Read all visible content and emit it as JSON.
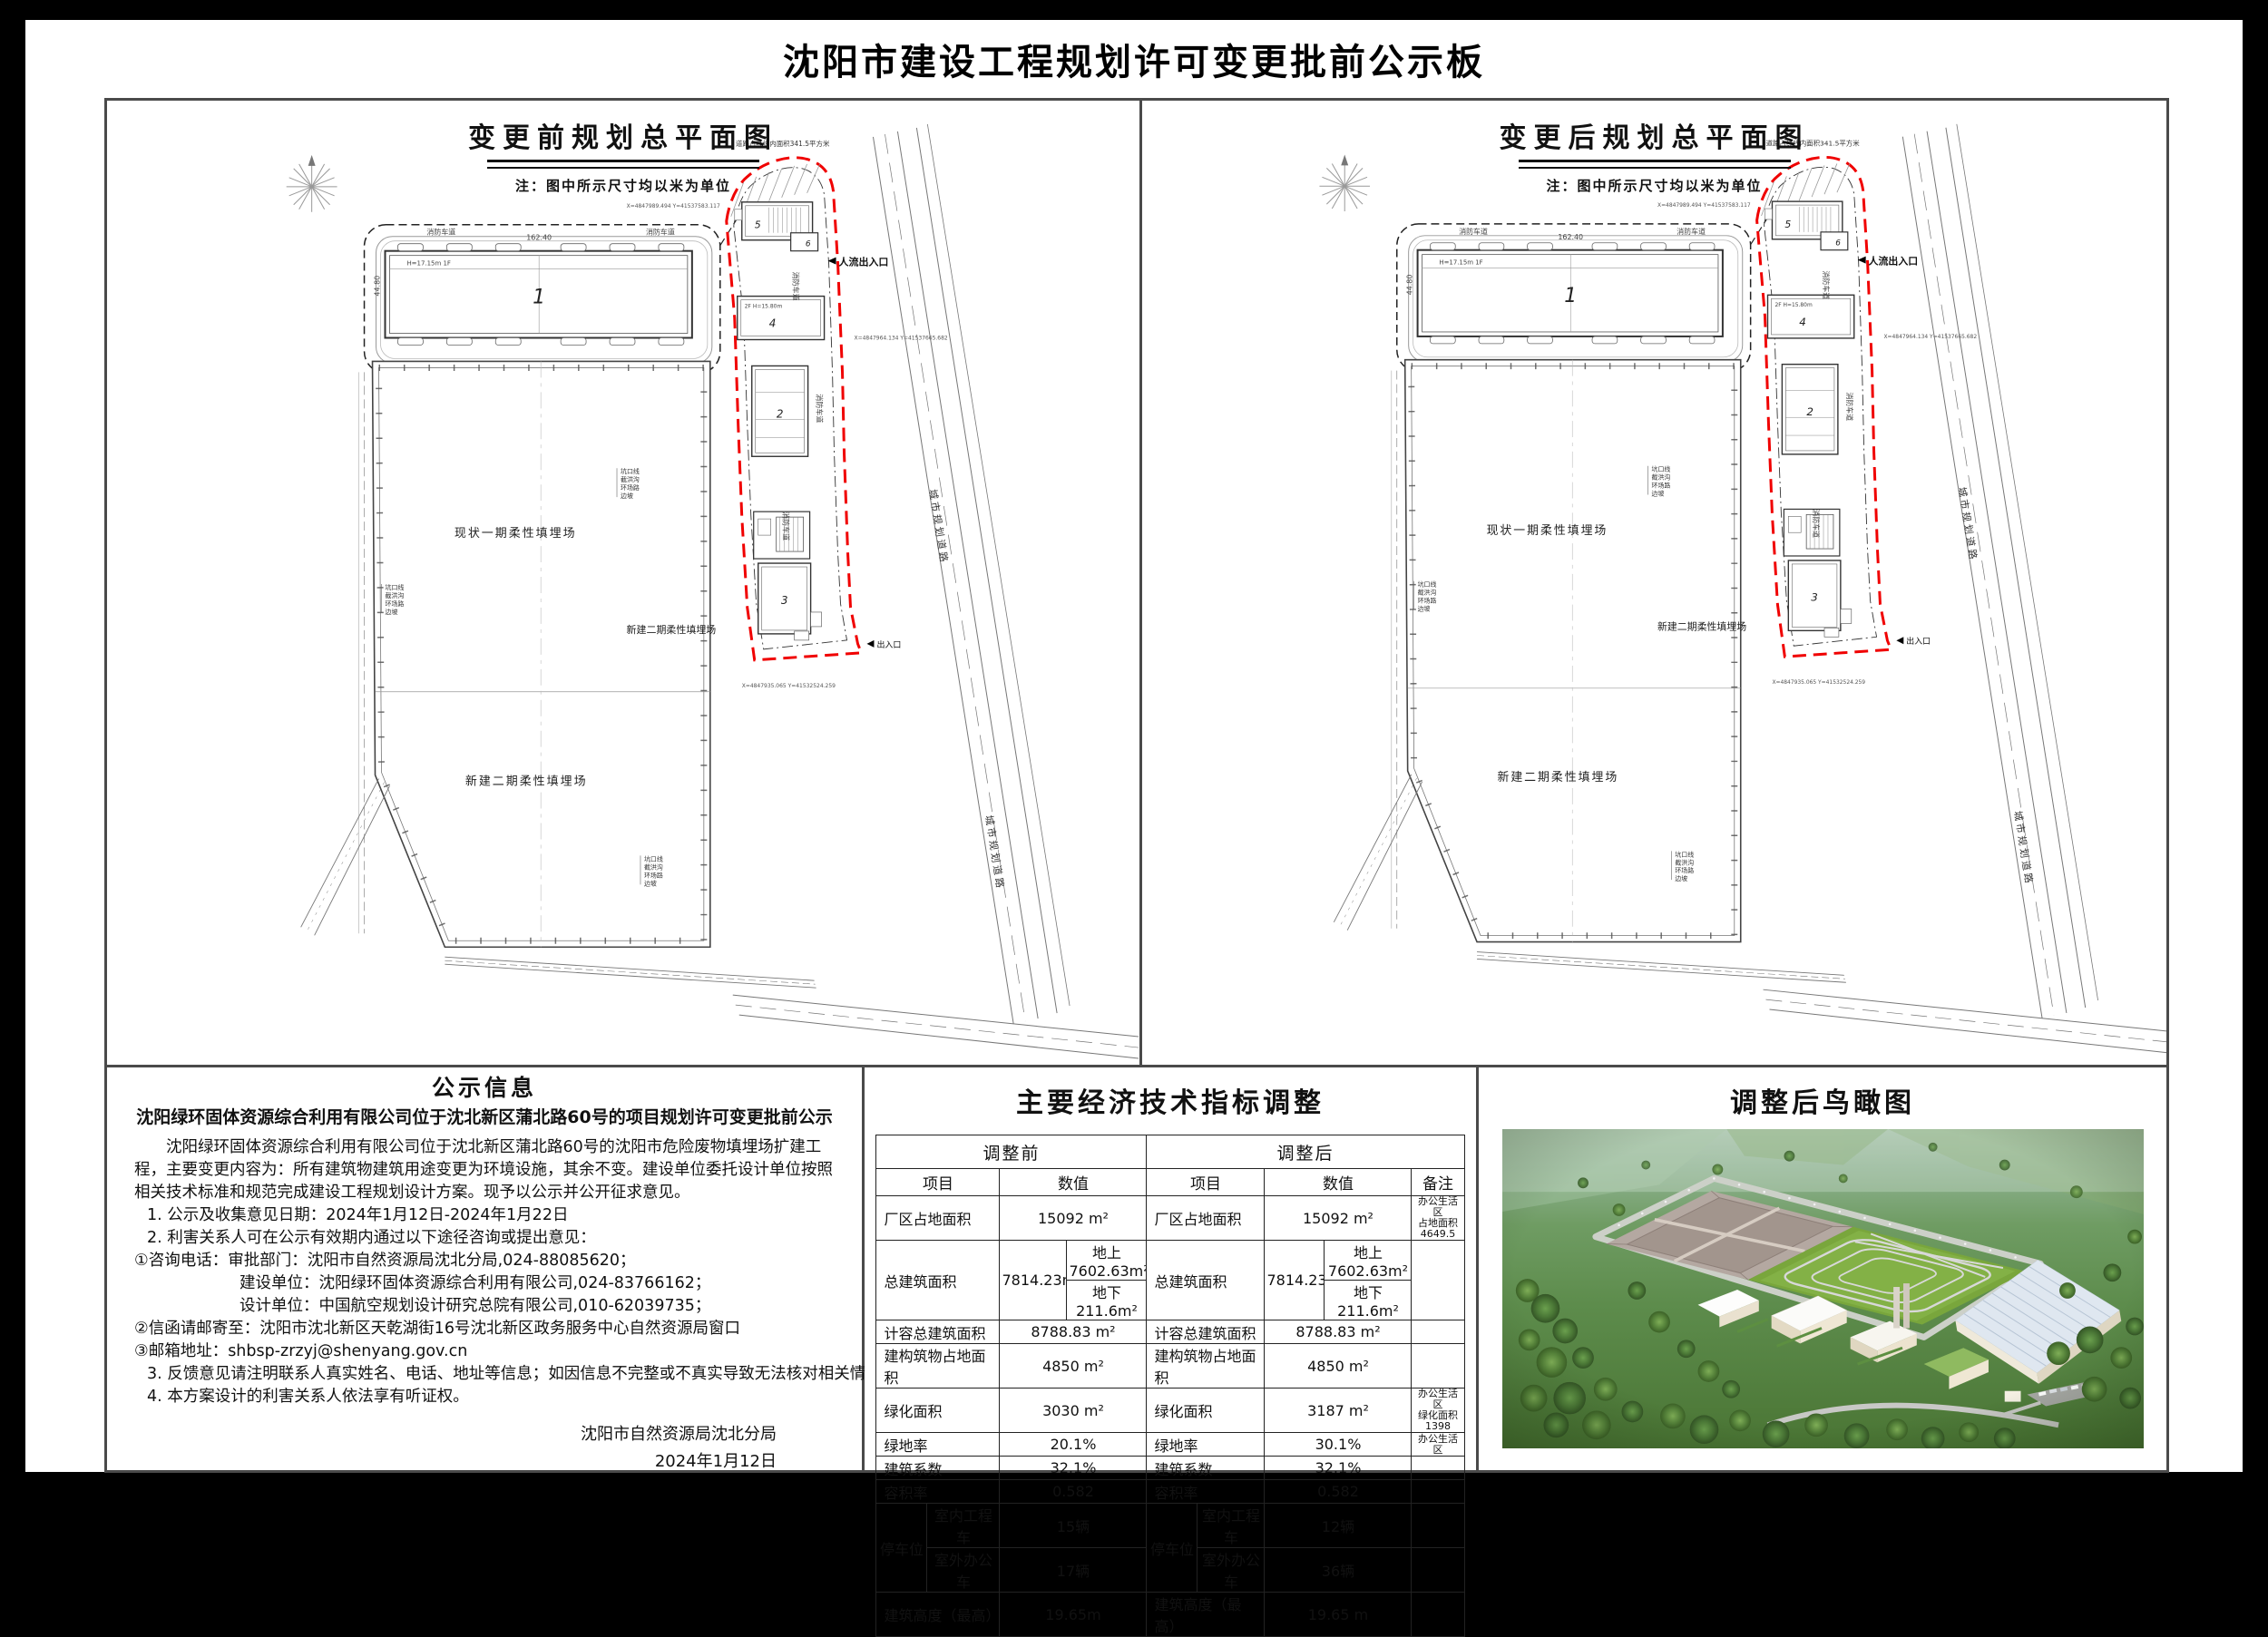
{
  "page_title": "沈阳市建设工程规划许可变更批前公示板",
  "panels": {
    "before": {
      "title": "变更前规划总平面图",
      "note": "注：图中所示尺寸均以米为单位"
    },
    "after": {
      "title": "变更后规划总平面图",
      "note": "注：图中所示尺寸均以米为单位"
    }
  },
  "plan": {
    "labels": {
      "phase1": "现状一期柔性填埋场",
      "phase2_mid": "新建二期柔性填埋场",
      "phase2_bottom": "新建二期柔性填埋场",
      "fire_lane": "消防车道",
      "entrance_main": "人流出入口",
      "entrance_side": "出入口",
      "city_road": "城市规划道路",
      "city_road2": "城市规划道路",
      "redline_area_note": "道路占红线内面积341.5平方米",
      "bldg1": "1",
      "bldg2": "2",
      "bldg3": "3",
      "bldg4": "4",
      "bldg5": "5",
      "bldg6": "6",
      "bldg1_spec": "H=17.15m 1F",
      "bldg4_spec": "2F H=15.80m",
      "dim_length": "162.40",
      "dim_width": "44.80",
      "legend1": "坑口线",
      "legend2": "截洪沟",
      "legend3": "环场路",
      "legend4": "边坡",
      "coord1": "X=4847989.494 Y=41537583.117",
      "coord2": "X=4847964.134 Y=41537665.682",
      "coord3": "X=4847935.065 Y=41532524.259"
    }
  },
  "notice": {
    "title": "公示信息",
    "subtitle": "沈阳绿环固体资源综合利用有限公司位于沈北新区蒲北路60号的项目规划许可变更批前公示",
    "paragraph": "沈阳绿环固体资源综合利用有限公司位于沈北新区蒲北路60号的沈阳市危险废物填埋场扩建工程，主要变更内容为：所有建筑物建筑用途变更为环境设施，其余不变。建设单位委托设计单位按照相关技术标准和规范完成建设工程规划设计方案。现予以公示并公开征求意见。",
    "lines": [
      "1. 公示及收集意见日期：2024年1月12日-2024年1月22日",
      "2. 利害关系人可在公示有效期内通过以下途径咨询或提出意见：",
      "①咨询电话：审批部门：沈阳市自然资源局沈北分局,024-88085620；",
      "建设单位：沈阳绿环固体资源综合利用有限公司,024-83766162；",
      "设计单位：中国航空规划设计研究总院有限公司,010-62039735；",
      "②信函请邮寄至：沈阳市沈北新区天乾湖街16号沈北新区政务服务中心自然资源局窗口",
      "③邮箱地址：shbsp-zrzyj@shenyang.gov.cn",
      "3. 反馈意见请注明联系人真实姓名、电话、地址等信息；如因信息不完整或不真实导致无法核对相关情况的，视为无效意见。",
      "4. 本方案设计的利害关系人依法享有听证权。"
    ],
    "signature": {
      "agency": "沈阳市自然资源局沈北分局",
      "date": "2024年1月12日"
    }
  },
  "table": {
    "title": "主要经济技术指标调整",
    "header": {
      "before": "调整前",
      "after": "调整后",
      "item": "项目",
      "value": "数值",
      "note": "备注"
    },
    "rows": {
      "site_area": {
        "item": "厂区占地面积",
        "before": "15092 m²",
        "after": "15092 m²",
        "note": "办公生活区\n占地面积4649.5"
      },
      "total_floor": {
        "item": "总建筑面积",
        "main": "7814.23m²",
        "above": "地上7602.63m²",
        "below": "地下211.6m²",
        "note": ""
      },
      "capacity": {
        "item": "计容总建筑面积",
        "before": "8788.83 m²",
        "after": "8788.83 m²",
        "note": ""
      },
      "structures": {
        "item": "建构筑物占地面积",
        "before": "4850 m²",
        "after": "4850 m²",
        "note": ""
      },
      "green_area": {
        "item": "绿化面积",
        "before": "3030 m²",
        "after": "3187 m²",
        "note": "办公生活区\n绿化面积1398"
      },
      "green_ratio": {
        "item": "绿地率",
        "before": "20.1%",
        "after": "30.1%",
        "note": "办公生活区"
      },
      "bldg_coeff": {
        "item": "建筑系数",
        "before": "32.1%",
        "after": "32.1%",
        "note": ""
      },
      "far": {
        "item": "容积率",
        "before": "0.582",
        "after": "0.582",
        "note": ""
      },
      "parking": {
        "group_label": "停车位",
        "indoor_label": "室内工程车",
        "outdoor_label": "室外办公车",
        "indoor_before": "15辆",
        "outdoor_before": "17辆",
        "indoor_after": "12辆",
        "outdoor_after": "36辆"
      },
      "height": {
        "item": "建筑高度（最高）",
        "before": "19.65m",
        "after": "19.65 m",
        "note": ""
      }
    }
  },
  "aerial": {
    "title": "调整后鸟瞰图"
  }
}
